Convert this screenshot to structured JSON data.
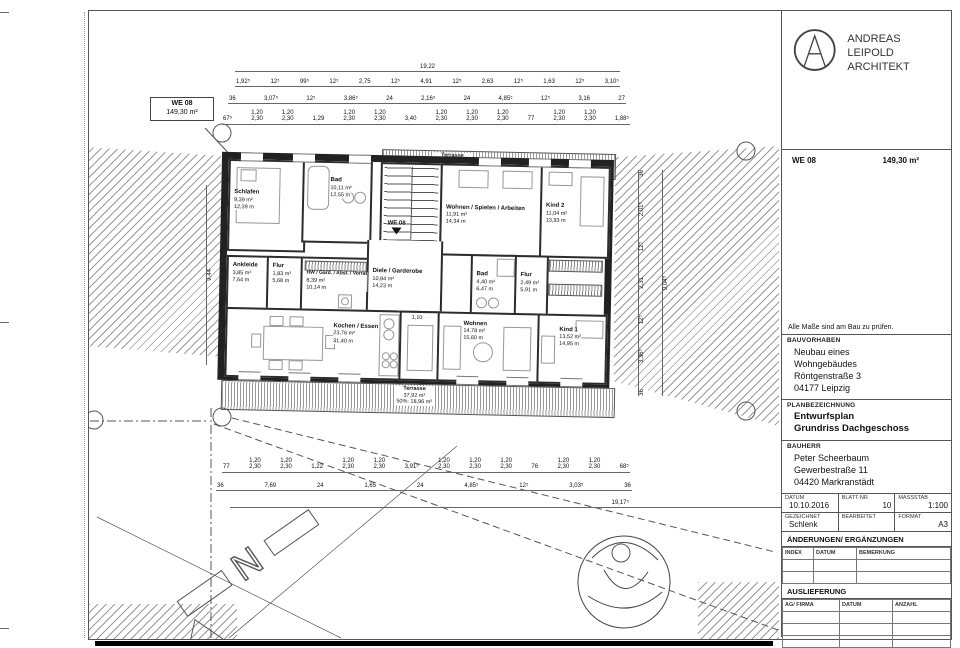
{
  "logo": {
    "line1": "ANDREAS LEIPOLD",
    "line2": "ARCHITEKT"
  },
  "titleblock": {
    "we_row": {
      "unit": "WE 08",
      "area": "149,30 m²"
    },
    "note": "Alle Maße sind am Bau zu prüfen.",
    "bauvorhaben": {
      "label": "BAUVORHABEN",
      "line1": "Neubau eines",
      "line2": "Wohngebäudes",
      "line3": "Röntgenstraße 3",
      "line4": "04177 Leipzig"
    },
    "planbezeichnung": {
      "label": "PLANBEZEICHNUNG",
      "line1": "Entwurfsplan",
      "line2": "Grundriss Dachgeschoss"
    },
    "bauherr": {
      "label": "BAUHERR",
      "line1": "Peter Scheerbaum",
      "line2": "Gewerbestraße 11",
      "line3": "04420 Markranstädt"
    },
    "info": {
      "datum_label": "DATUM",
      "datum": "10.10.2016",
      "blatt_label": "BLATT-NR",
      "blatt": "10",
      "massstab_label": "MASSSTAB",
      "massstab": "1:100",
      "gezeichnet_label": "GEZEICHNET",
      "gezeichnet": "Schlenk",
      "bearbeitet_label": "BEARBEITET",
      "bearbeitet": "",
      "format_label": "FORMAT",
      "format": "A3"
    },
    "aenderungen": {
      "label": "ÄNDERUNGEN/ ERGÄNZUNGEN",
      "columns": [
        "INDEX",
        "DATUM",
        "BEMERKUNG"
      ]
    },
    "auslieferung": {
      "label": "AUSLIEFERUNG",
      "columns": [
        "AG/ FIRMA",
        "DATUM",
        "ANZAHL"
      ]
    }
  },
  "plan": {
    "unit_box": {
      "line1": "WE 08",
      "line2": "149,30 m²"
    },
    "entry_label": "WE 08",
    "north_label": "N",
    "rooms": [
      {
        "name": "Schlafen",
        "area": "9,39 m²",
        "floor": "12,39 m"
      },
      {
        "name": "Bad",
        "area": "10,11 m²",
        "floor": "12,55 m"
      },
      {
        "name": "Ankleide",
        "area": "3,85 m²",
        "floor": "7,64 m"
      },
      {
        "name": "Flur",
        "area": "1,83 m²",
        "floor": "5,68 m"
      },
      {
        "name": "HW / Gard. / Abst. / Vorrat",
        "area": "8,39 m²",
        "floor": "10,14 m"
      },
      {
        "name": "Diele / Garderobe",
        "area": "10,84 m²",
        "floor": "14,23 m"
      },
      {
        "name": "Kochen / Essen",
        "area": "23,76 m²",
        "floor": "31,40 m"
      },
      {
        "name": "Wohnen / Spielen / Arbeiten",
        "area": "11,91 m²",
        "floor": "14,34 m"
      },
      {
        "name": "Kind 2",
        "area": "11,04 m²",
        "floor": "13,93 m"
      },
      {
        "name": "Bad",
        "area": "4,40 m²",
        "floor": "6,47 m"
      },
      {
        "name": "Flur",
        "area": "2,49 m²",
        "floor": "5,91 m"
      },
      {
        "name": "Wohnen",
        "area": "14,78 m²",
        "floor": "15,60 m"
      },
      {
        "name": "Kind 1",
        "area": "13,52 m²",
        "floor": "14,95 m"
      }
    ],
    "terraces": {
      "top": {
        "name": "Terrasse",
        "area": "15,91 m²",
        "half": "50%: 7,96 m²"
      },
      "bottom": {
        "name": "Terrasse",
        "area": "37,92 m²",
        "half": "50%: 18,96 m²"
      }
    },
    "dimensions": {
      "top_overall": "19,22",
      "top_row2": [
        "1,92⁵",
        "12⁵",
        "99⁵",
        "12⁵",
        "2,75",
        "12⁵",
        "4,91",
        "12⁵",
        "2,63",
        "12⁵",
        "1,63",
        "12⁵",
        "3,10⁵"
      ],
      "top_row3": [
        "36",
        "3,07⁵",
        "12⁵",
        "3,86⁵",
        "24",
        "2,16⁵",
        "24",
        "4,85⁵",
        "12⁵",
        "3,16",
        "27"
      ],
      "top_windows": [
        "67⁵",
        "1,20\n2,30",
        "1,20\n2,30",
        "1,29",
        "1,20\n2,30",
        "1,20\n2,30",
        "3,40",
        "1,20\n2,30",
        "1,20\n2,30",
        "1,20\n2,30",
        "77",
        "1,20\n2,30",
        "1,20\n2,30",
        "1,88⁵"
      ],
      "bottom_windows": [
        "77",
        "1,20\n2,30",
        "1,20\n2,30",
        "1,22",
        "1,20\n2,30",
        "1,20\n2,30",
        "3,91⁵",
        "1,20\n2,30",
        "1,20\n2,30",
        "1,20\n2,30",
        "76",
        "1,20\n2,30",
        "1,20\n2,30",
        "68⁵"
      ],
      "bottom_row2": [
        "36",
        "7,69",
        "24",
        "1,65",
        "24",
        "4,85⁵",
        "12⁵",
        "3,03⁵",
        "36"
      ],
      "bottom_overall": "19,17⁵",
      "right_chain": [
        "36",
        "2,01⁵",
        "12⁵",
        "2,31",
        "12⁵",
        "3,36⁵",
        "36"
      ],
      "right_overall": "9,04⁵",
      "left_overall": "9,44",
      "shaft": "1,10"
    }
  }
}
